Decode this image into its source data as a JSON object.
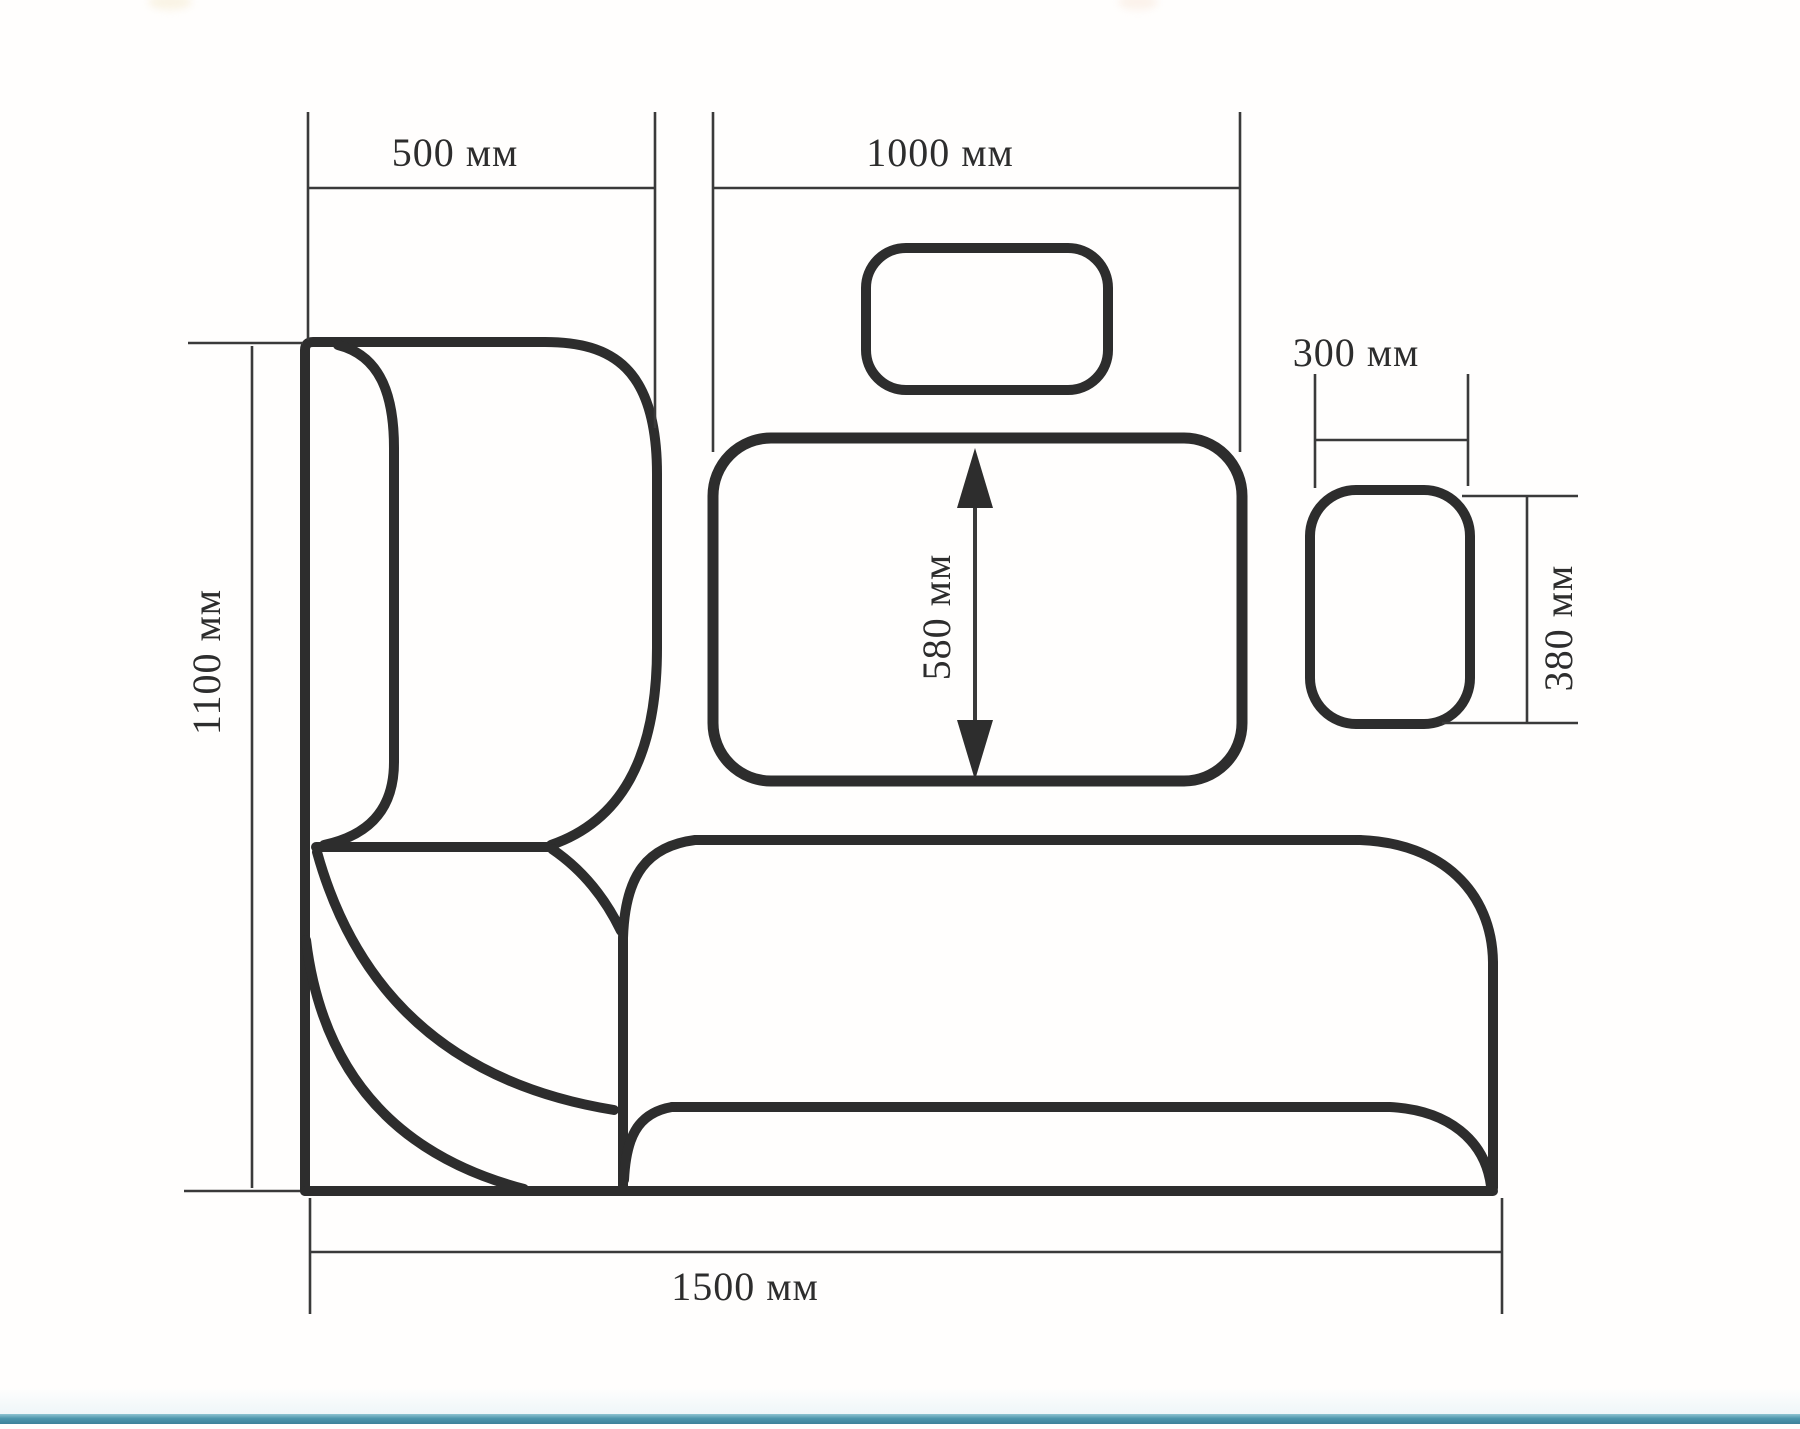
{
  "drawing": {
    "type": "furniture-dimension-plan",
    "subject": "corner kitchen bench set: L-shaped bench, dining table, two stools (top view)",
    "unit": "мм",
    "ink_color": "#2d2d2d",
    "background": "#fffefd",
    "footer_bar_color": "#4c96ad",
    "components": [
      "corner-bench-left-back",
      "corner-seat-wedge",
      "bench-bottom-wing",
      "dining-table",
      "stool-above-table",
      "stool-right"
    ],
    "dimensions": {
      "bench_left_width": {
        "label": "500 мм",
        "value": 500
      },
      "table_width": {
        "label": "1000 мм",
        "value": 1000
      },
      "stool_width": {
        "label": "300 мм",
        "value": 300
      },
      "table_depth": {
        "label": "580 мм",
        "value": 580
      },
      "stool_depth": {
        "label": "380 мм",
        "value": 380
      },
      "bench_left_length": {
        "label": "1100 мм",
        "value": 1100
      },
      "bench_bottom_length": {
        "label": "1500 мм",
        "value": 1500
      }
    }
  }
}
